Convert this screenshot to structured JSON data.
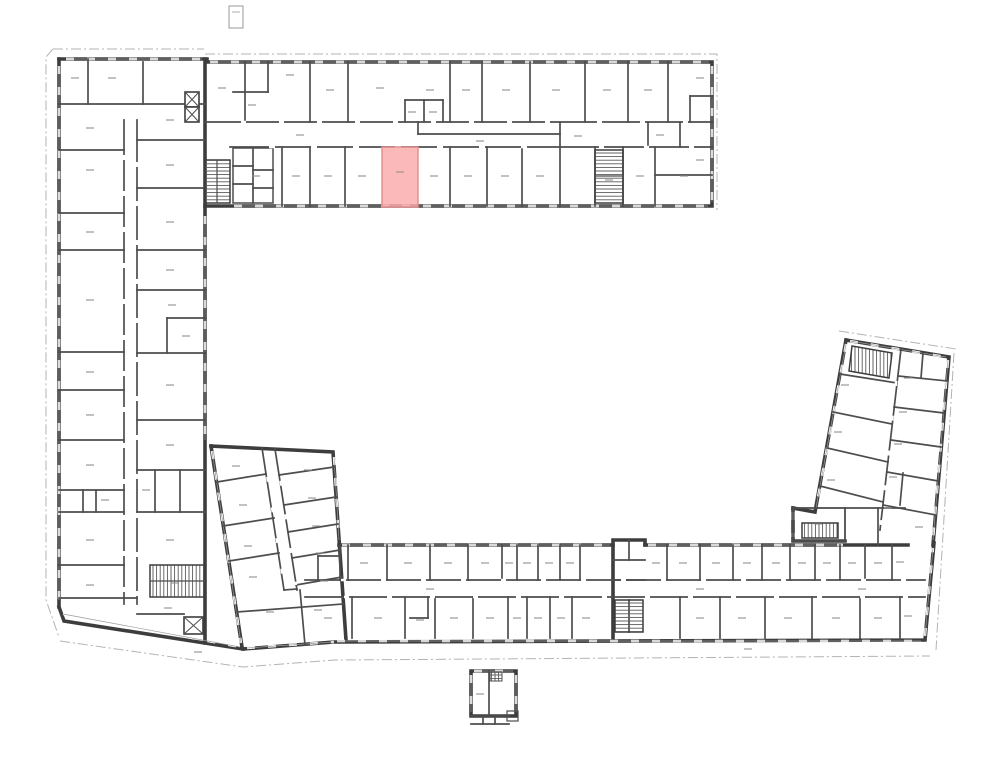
{
  "page": {
    "title": "Building floor plan with highlighted unit",
    "background": "#ffffff"
  },
  "floor_plan": {
    "kind": "architectural-floor-plan",
    "colors": {
      "exterior_wall": "#3d3d3d",
      "interior_wall": "#4d4d4d",
      "window_line": "#9a9a9a",
      "site_line": "#b3b3b3",
      "stair_hatch": "#5a5a5a",
      "dimension_mark": "#8f8f8f",
      "background": "#ffffff"
    },
    "highlighted_room": {
      "x": 382,
      "y": 147,
      "width": 36,
      "height": 60,
      "fill": "#fba9a9",
      "stroke": "#e28a8a",
      "opacity": 0.82
    }
  }
}
